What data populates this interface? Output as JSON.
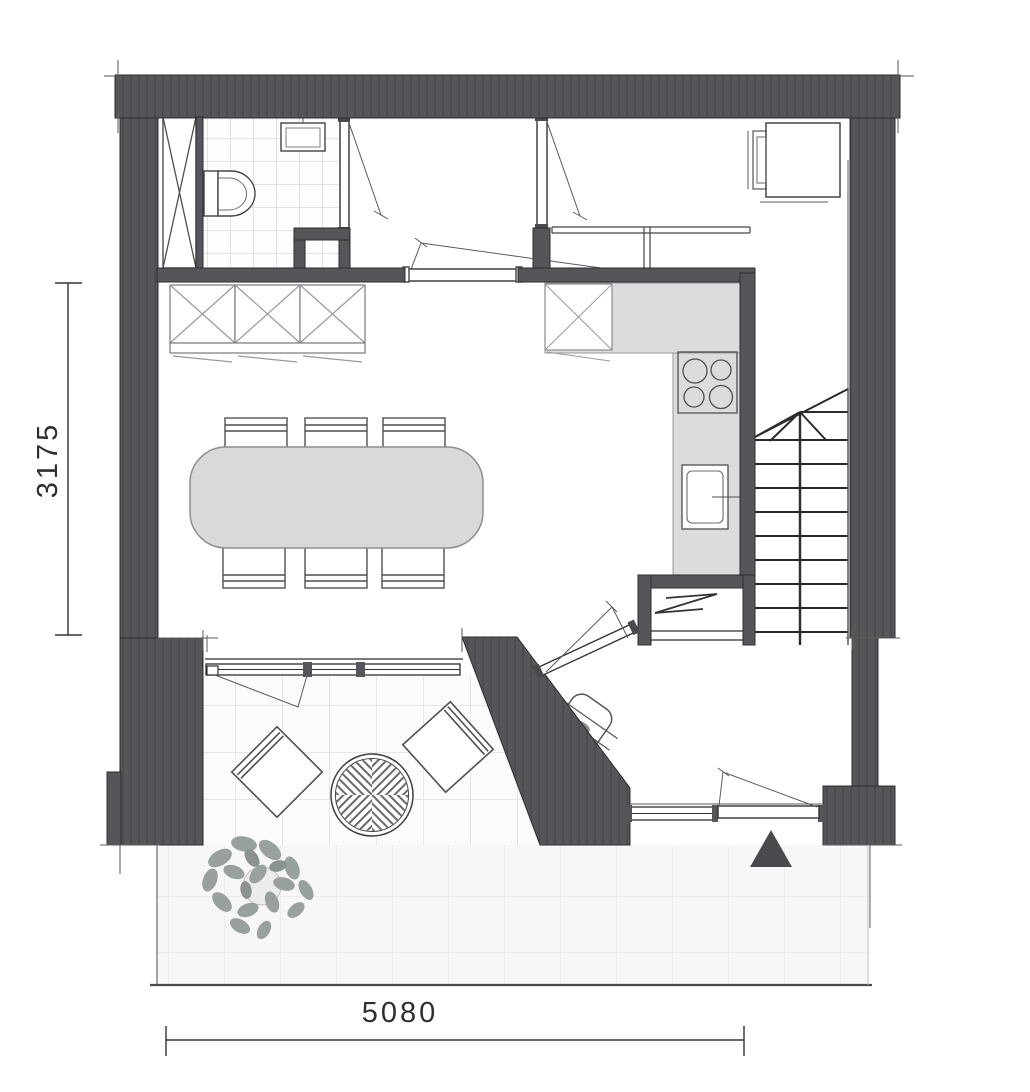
{
  "document": {
    "type": "architectural floor plan",
    "page_background": "#ffffff"
  },
  "dimensions": {
    "left_vertical": {
      "label": "3175",
      "orientation": "vertical"
    },
    "bottom_horizontal": {
      "label": "5080",
      "orientation": "horizontal"
    }
  },
  "palette": {
    "wall": "#55565a",
    "wall_outline": "#2d2d30",
    "thin_line": "#2e2e2e",
    "counter_fill": "#dcdcdc",
    "table_fill": "#d9d9d9",
    "bath_tile_line": "#c9c9c9",
    "terrace_tile_line": "#d9dadb",
    "lower_tile_line": "#e7e7e7",
    "entrance_marker": "#4a4a4e",
    "plant_leaf": "#99a19d"
  },
  "symbols": [
    "toilet",
    "washbasin",
    "service-shaft",
    "wardrobe-closets",
    "interior-door",
    "kitchen-counter",
    "upper-cabinet",
    "hob-4-burner",
    "kitchen-sink",
    "radiator",
    "staircase-up",
    "dining-table-6-chairs",
    "washing-machine",
    "window-wall",
    "lounge-chair",
    "round-garden-table",
    "potted-plant",
    "coat-rack",
    "entrance-door",
    "entrance-triangle-marker"
  ]
}
